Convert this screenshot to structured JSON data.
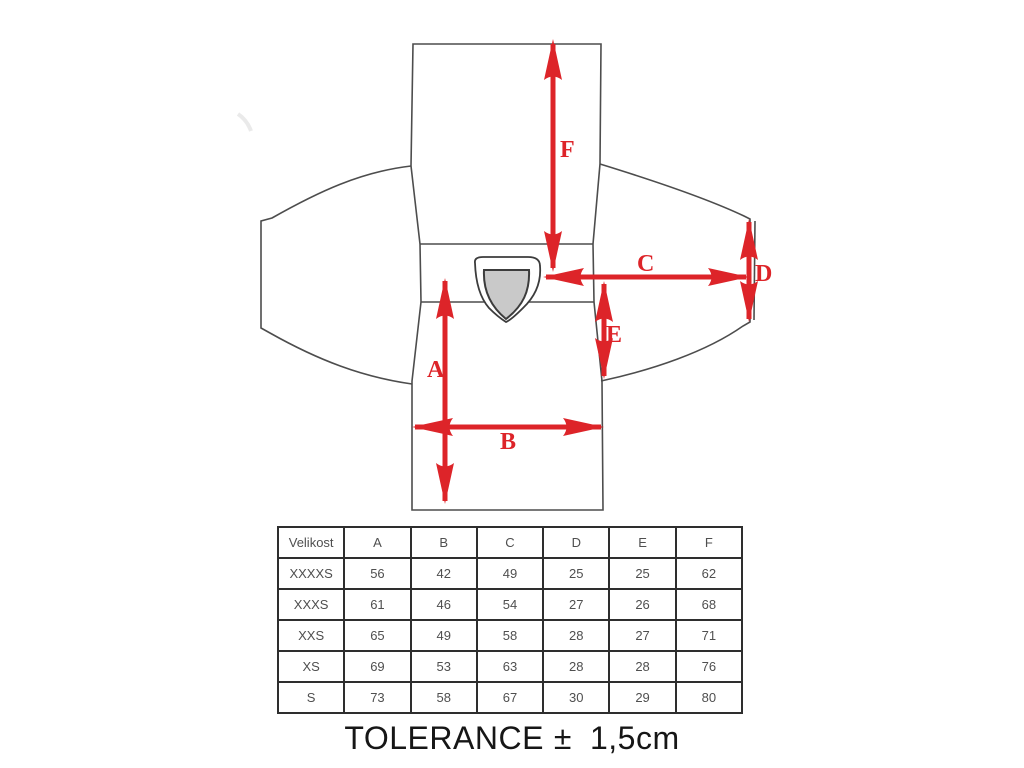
{
  "page": {
    "background": "#ffffff",
    "accent_red": "#dd2429",
    "outline_gray": "#4d4d4d",
    "badge_gray": "#c9c9c9",
    "table_border": "#2e2e2e"
  },
  "diagram": {
    "type": "garment-measurement-diagram",
    "labels": {
      "A": "A",
      "B": "B",
      "C": "C",
      "D": "D",
      "E": "E",
      "F": "F"
    }
  },
  "table": {
    "headers": [
      "Velikost",
      "A",
      "B",
      "C",
      "D",
      "E",
      "F"
    ],
    "rows": [
      [
        "XXXXS",
        "56",
        "42",
        "49",
        "25",
        "25",
        "62"
      ],
      [
        "XXXS",
        "61",
        "46",
        "54",
        "27",
        "26",
        "68"
      ],
      [
        "XXS",
        "65",
        "49",
        "58",
        "28",
        "27",
        "71"
      ],
      [
        "XS",
        "69",
        "53",
        "63",
        "28",
        "28",
        "76"
      ],
      [
        "S",
        "73",
        "58",
        "67",
        "30",
        "29",
        "80"
      ]
    ]
  },
  "tolerance": {
    "label": "TOLERANCE",
    "symbol": "±",
    "value": "1,5cm"
  }
}
